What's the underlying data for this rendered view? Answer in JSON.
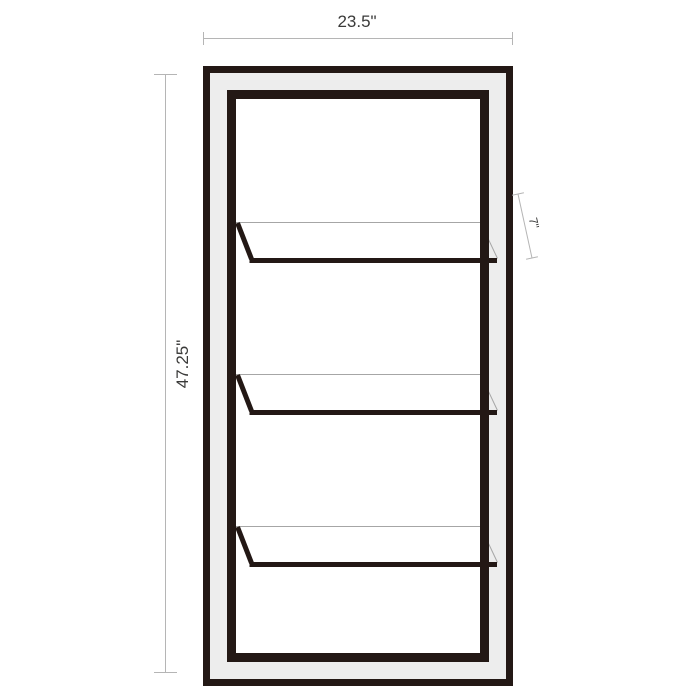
{
  "figure": {
    "subject": "bookcase front-view dimension diagram",
    "shelf_count": 3
  },
  "dimensions": {
    "width": "23.5\"",
    "height": "47.25\"",
    "depth": "7\""
  },
  "colors": {
    "background": "#ffffff",
    "outline": "#231815",
    "frame_fill": "#ededed",
    "interior_fill": "#ffffff",
    "dimension_line": "#b5b5b5",
    "shelf_back_line": "#a6a6a6",
    "text": "#3a3a39"
  }
}
